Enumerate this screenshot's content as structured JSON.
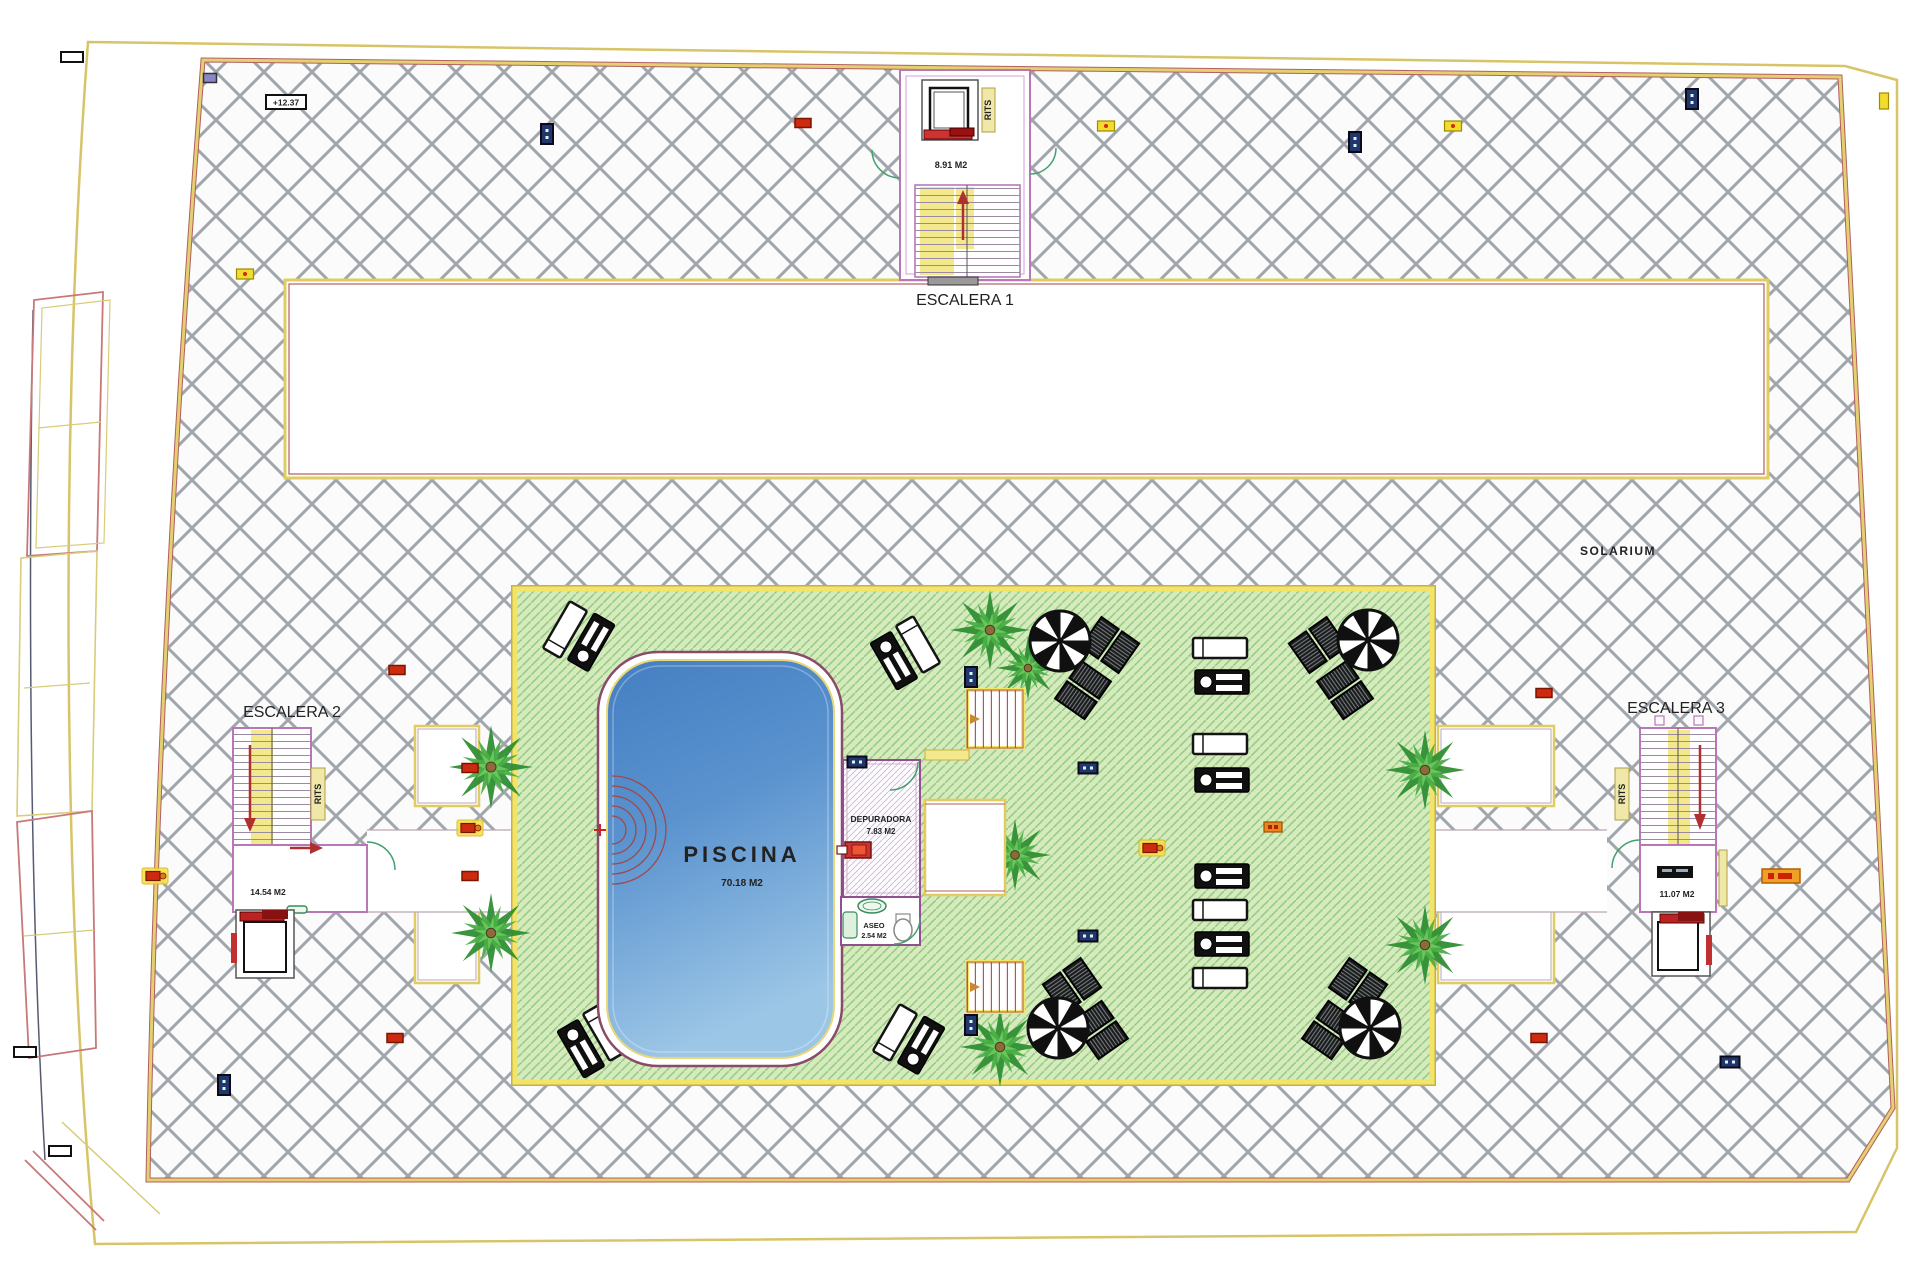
{
  "plan": {
    "solarium_label": "SOLARIUM",
    "elevation_marker": "+12.37",
    "pool": {
      "name": "PISCINA",
      "area": "70.18 M2"
    },
    "depuradora": {
      "name": "DEPURADORA",
      "area": "7.83 M2"
    },
    "aseo": {
      "name": "ASEO",
      "area": "2.54 M2"
    },
    "stairs": [
      {
        "title": "ESCALERA 1",
        "area": "8.91 M2",
        "rits": "RITS"
      },
      {
        "title": "ESCALERA 2",
        "area": "14.54 M2",
        "rits": "RITS"
      },
      {
        "title": "ESCALERA 3",
        "area": "11.07 M2",
        "rits": "RITS"
      }
    ],
    "colors": {
      "hatch_line": "#a0a6ac",
      "deck_green": "#d6eabe",
      "deck_hatch": "#94ce84",
      "pool_blue": "#5b93cf",
      "wall_purple": "#b878b8",
      "border_yellow": "#eed86a",
      "accent_red": "#cc2b10",
      "marker_blue": "#24356e",
      "door_green": "#44a070"
    },
    "markers": [
      {
        "t": "red",
        "x": 803,
        "y": 123
      },
      {
        "t": "blue-v",
        "x": 547,
        "y": 134
      },
      {
        "t": "yellow",
        "x": 1106,
        "y": 126
      },
      {
        "t": "blue-v",
        "x": 1355,
        "y": 142
      },
      {
        "t": "yellow",
        "x": 1453,
        "y": 126
      },
      {
        "t": "blue-v",
        "x": 1692,
        "y": 99
      },
      {
        "t": "yellow-v",
        "x": 1884,
        "y": 101
      },
      {
        "t": "yellow",
        "x": 245,
        "y": 274
      },
      {
        "t": "red",
        "x": 397,
        "y": 670
      },
      {
        "t": "red",
        "x": 470,
        "y": 768
      },
      {
        "t": "red-yellow",
        "x": 470,
        "y": 828
      },
      {
        "t": "red",
        "x": 470,
        "y": 876
      },
      {
        "t": "blue",
        "x": 857,
        "y": 762
      },
      {
        "t": "blue",
        "x": 1088,
        "y": 768
      },
      {
        "t": "blue-v",
        "x": 971,
        "y": 677
      },
      {
        "t": "blue-v",
        "x": 971,
        "y": 1025
      },
      {
        "t": "orange",
        "x": 1273,
        "y": 827
      },
      {
        "t": "red-yellow",
        "x": 1152,
        "y": 848
      },
      {
        "t": "blue",
        "x": 1088,
        "y": 936
      },
      {
        "t": "red",
        "x": 395,
        "y": 1038
      },
      {
        "t": "blue-v",
        "x": 224,
        "y": 1085
      },
      {
        "t": "red",
        "x": 1539,
        "y": 1038
      },
      {
        "t": "red",
        "x": 1544,
        "y": 693
      },
      {
        "t": "orange-tag",
        "x": 1781,
        "y": 876
      },
      {
        "t": "red-yellow",
        "x": 155,
        "y": 876
      },
      {
        "t": "blue",
        "x": 1730,
        "y": 1062
      },
      {
        "t": "tick",
        "x": 72,
        "y": 57
      },
      {
        "t": "tick-purple",
        "x": 210,
        "y": 78
      },
      {
        "t": "tick",
        "x": 60,
        "y": 1151
      },
      {
        "t": "tick",
        "x": 25,
        "y": 1052
      }
    ],
    "palms": [
      [
        491,
        767,
        42
      ],
      [
        491,
        933,
        40
      ],
      [
        990,
        630,
        40
      ],
      [
        1028,
        668,
        32
      ],
      [
        1015,
        855,
        36
      ],
      [
        1425,
        770,
        40
      ],
      [
        1425,
        945,
        40
      ],
      [
        1000,
        1047,
        40
      ]
    ],
    "parasols": [
      [
        1060,
        641
      ],
      [
        1368,
        640
      ],
      [
        1058,
        1028
      ],
      [
        1370,
        1028
      ]
    ],
    "parasol_duos": [
      [
        1110,
        645,
        35
      ],
      [
        1083,
        690,
        125
      ],
      [
        1318,
        645,
        -35
      ],
      [
        1345,
        690,
        -125
      ],
      [
        1072,
        986,
        -35
      ],
      [
        1100,
        1030,
        55
      ],
      [
        1358,
        986,
        35
      ],
      [
        1330,
        1030,
        -55
      ]
    ],
    "lounger_pairs": [
      {
        "x": 578,
        "y": 637,
        "rot": -60
      },
      {
        "x": 905,
        "y": 652,
        "rot": 60
      },
      {
        "x": 908,
        "y": 1040,
        "rot": -60
      },
      {
        "x": 592,
        "y": 1040,
        "rot": 60
      }
    ],
    "lounger_stack": [
      {
        "x": 1220,
        "y": 648,
        "kind": "white"
      },
      {
        "x": 1222,
        "y": 682,
        "kind": "detail"
      },
      {
        "x": 1220,
        "y": 744,
        "kind": "white"
      },
      {
        "x": 1222,
        "y": 780,
        "kind": "detail"
      },
      {
        "x": 1222,
        "y": 876,
        "kind": "detail"
      },
      {
        "x": 1220,
        "y": 910,
        "kind": "white"
      },
      {
        "x": 1222,
        "y": 944,
        "kind": "detail"
      },
      {
        "x": 1220,
        "y": 978,
        "kind": "white"
      }
    ],
    "entry_steps": [
      {
        "x": 967,
        "y": 690,
        "w": 56,
        "h": 58
      },
      {
        "x": 967,
        "y": 962,
        "w": 56,
        "h": 50
      }
    ]
  }
}
